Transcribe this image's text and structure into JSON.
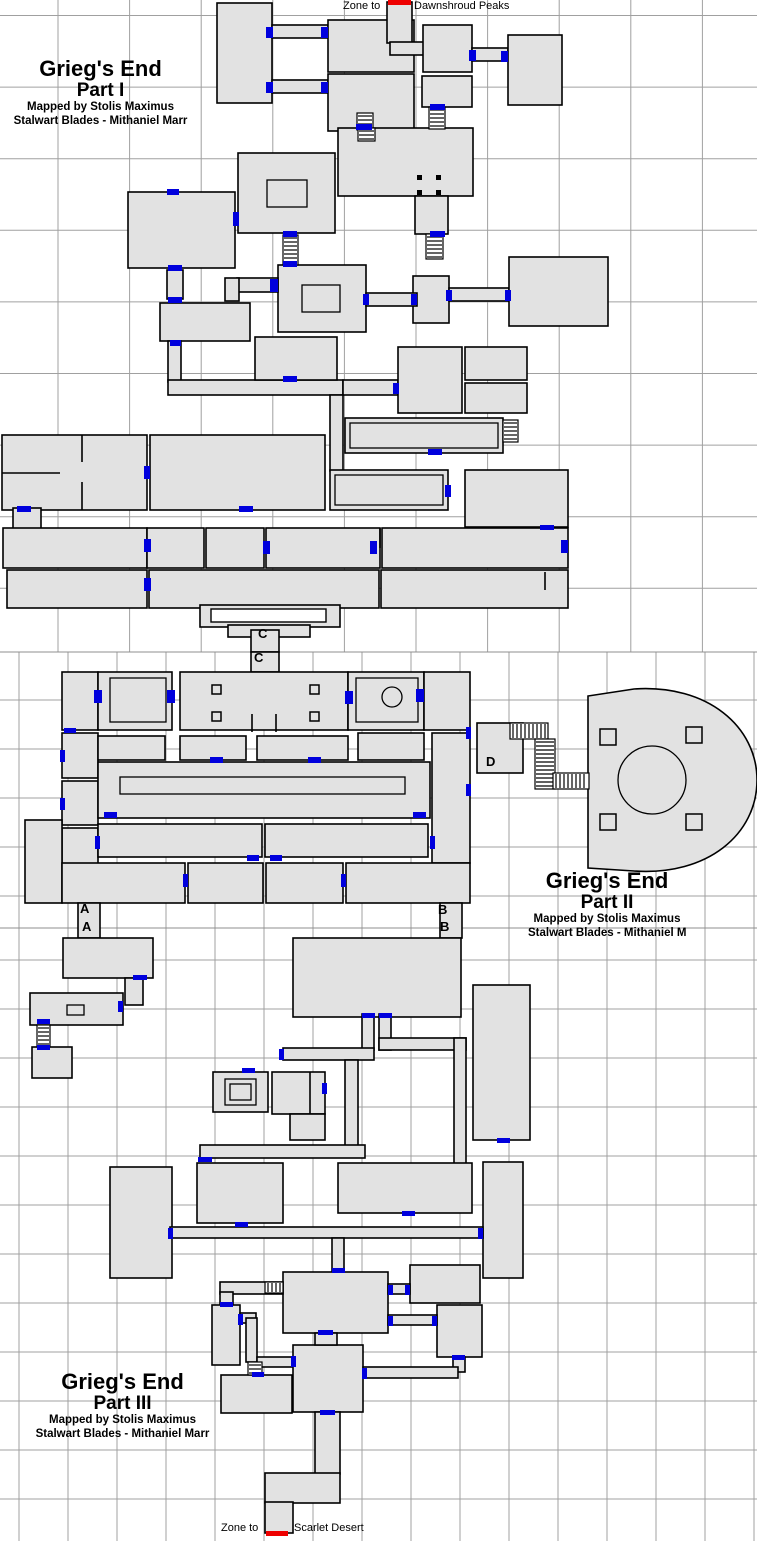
{
  "page": {
    "width": 757,
    "height": 1541,
    "background": "#ffffff"
  },
  "colors": {
    "room_fill": "#e2e2e2",
    "wall": "#000000",
    "door": "#0000dd",
    "zone_line": "#ee0000",
    "grid": "#a0a0a0",
    "seam": "#8f8f8f",
    "ladder_fill": "#ffffff",
    "text": "#000000"
  },
  "zone_labels": {
    "top_prefix": "Zone to",
    "top_zone": "Dawnshroud Peaks",
    "top_prefix_pos": {
      "x": 343,
      "y": 0
    },
    "top_zone_pos": {
      "x": 414,
      "y": 0
    },
    "bottom_prefix": "Zone to",
    "bottom_zone": "Scarlet Desert",
    "bottom_prefix_pos": {
      "x": 221,
      "y": 1522
    },
    "bottom_zone_pos": {
      "x": 294,
      "y": 1522
    }
  },
  "titles": [
    {
      "line1": "Grieg's End",
      "line2": "Part I",
      "line3": "Mapped by Stolis Maximus",
      "line4": "Stalwart Blades - Mithaniel Marr",
      "pos": {
        "x": 8,
        "y": 57,
        "w": 185
      }
    },
    {
      "line1": "Grieg's End",
      "line2": "Part II",
      "line3": "Mapped by Stolis Maximus",
      "line4": "Stalwart Blades - Mithaniel Marr",
      "pos": {
        "x": 528,
        "y": 869,
        "w": 158
      }
    },
    {
      "line1": "Grieg's End",
      "line2": "Part III",
      "line3": "Mapped by Stolis Maximus",
      "line4": "Stalwart Blades - Mithaniel Marr",
      "pos": {
        "x": 25,
        "y": 1370,
        "w": 195
      }
    }
  ],
  "letters": [
    {
      "text": "C",
      "x": 258,
      "y": 626
    },
    {
      "text": "C",
      "y": 650,
      "x": 254
    },
    {
      "text": "A",
      "x": 80,
      "y": 901
    },
    {
      "text": "A",
      "x": 82,
      "y": 919
    },
    {
      "text": "B",
      "x": 438,
      "y": 902
    },
    {
      "text": "B",
      "x": 440,
      "y": 919
    },
    {
      "text": "D",
      "x": 486,
      "y": 754
    }
  ],
  "map": {
    "grid_sections": [
      {
        "y0": 0,
        "y1": 652,
        "vx0": -13.6,
        "vstep": 71.6,
        "hy0": 15.5,
        "hstep": 71.6
      },
      {
        "y0": 652,
        "y1": 928,
        "vx0": 19,
        "vstep": 49,
        "hy0": 651,
        "hstep": 49
      },
      {
        "y0": 928,
        "y1": 1541,
        "vx0": 19,
        "vstep": 49,
        "hy0": 911,
        "hstep": 49
      }
    ],
    "seams": [
      652,
      928
    ],
    "rooms": [
      [
        217,
        3,
        55,
        100
      ],
      [
        272,
        25,
        56,
        13
      ],
      [
        272,
        80,
        56,
        13
      ],
      [
        328,
        20,
        86,
        52
      ],
      [
        328,
        74,
        86,
        57
      ],
      [
        387,
        2,
        25,
        41
      ],
      [
        390,
        42,
        48,
        13
      ],
      [
        423,
        25,
        49,
        47
      ],
      [
        472,
        48,
        36,
        13
      ],
      [
        508,
        35,
        54,
        70
      ],
      [
        422,
        76,
        50,
        31
      ],
      [
        338,
        128,
        135,
        68
      ],
      [
        415,
        196,
        33,
        38
      ],
      [
        413,
        276,
        36,
        47
      ],
      [
        449,
        288,
        60,
        13
      ],
      [
        509,
        257,
        99,
        69
      ],
      [
        238,
        153,
        97,
        80
      ],
      [
        278,
        265,
        88,
        67
      ],
      [
        366,
        293,
        51,
        13
      ],
      [
        128,
        192,
        107,
        76
      ],
      [
        237,
        278,
        41,
        14
      ],
      [
        225,
        278,
        14,
        23
      ],
      [
        167,
        270,
        16,
        29
      ],
      [
        160,
        303,
        90,
        38
      ],
      [
        168,
        341,
        13,
        41
      ],
      [
        168,
        380,
        175,
        15
      ],
      [
        343,
        380,
        55,
        15
      ],
      [
        330,
        395,
        13,
        76
      ],
      [
        398,
        347,
        64,
        66
      ],
      [
        465,
        347,
        62,
        33
      ],
      [
        465,
        383,
        62,
        30
      ],
      [
        345,
        418,
        158,
        35
      ],
      [
        330,
        470,
        118,
        40
      ],
      [
        465,
        470,
        103,
        57
      ],
      [
        2,
        435,
        145,
        75
      ],
      [
        150,
        435,
        175,
        75
      ],
      [
        13,
        508,
        28,
        22
      ],
      [
        3,
        528,
        144,
        40
      ],
      [
        147,
        528,
        57,
        40
      ],
      [
        206,
        528,
        58,
        40
      ],
      [
        266,
        528,
        114,
        40
      ],
      [
        382,
        528,
        186,
        40
      ],
      [
        7,
        570,
        140,
        38
      ],
      [
        149,
        570,
        230,
        38
      ],
      [
        381,
        570,
        187,
        38
      ],
      [
        200,
        605,
        140,
        22
      ],
      [
        228,
        625,
        82,
        12
      ],
      [
        251,
        630,
        28,
        22
      ],
      [
        255,
        337,
        82,
        43
      ],
      [
        251,
        652,
        28,
        20
      ],
      [
        62,
        672,
        36,
        58
      ],
      [
        98,
        672,
        74,
        58
      ],
      [
        180,
        672,
        168,
        58
      ],
      [
        348,
        672,
        76,
        58
      ],
      [
        424,
        672,
        46,
        58
      ],
      [
        62,
        733,
        36,
        45
      ],
      [
        62,
        781,
        36,
        44
      ],
      [
        98,
        736,
        67,
        24
      ],
      [
        180,
        736,
        66,
        24
      ],
      [
        257,
        736,
        91,
        24
      ],
      [
        358,
        733,
        66,
        27
      ],
      [
        98,
        762,
        332,
        56
      ],
      [
        62,
        828,
        36,
        38
      ],
      [
        25,
        820,
        37,
        83
      ],
      [
        432,
        733,
        38,
        130
      ],
      [
        98,
        824,
        164,
        33
      ],
      [
        265,
        824,
        163,
        33
      ],
      [
        62,
        863,
        123,
        40
      ],
      [
        188,
        863,
        75,
        40
      ],
      [
        266,
        863,
        77,
        40
      ],
      [
        346,
        863,
        124,
        40
      ],
      [
        78,
        903,
        22,
        35
      ],
      [
        440,
        903,
        22,
        35
      ],
      [
        477,
        723,
        46,
        50
      ],
      [
        63,
        938,
        90,
        40
      ],
      [
        125,
        978,
        18,
        27
      ],
      [
        30,
        993,
        93,
        32
      ],
      [
        32,
        1047,
        40,
        31
      ],
      [
        293,
        938,
        168,
        79
      ],
      [
        473,
        985,
        57,
        155
      ],
      [
        362,
        1014,
        12,
        36
      ],
      [
        283,
        1048,
        91,
        12
      ],
      [
        379,
        1014,
        12,
        36
      ],
      [
        379,
        1038,
        87,
        12
      ],
      [
        454,
        1038,
        12,
        126
      ],
      [
        213,
        1072,
        55,
        40
      ],
      [
        272,
        1072,
        53,
        42
      ],
      [
        290,
        1114,
        35,
        26
      ],
      [
        345,
        1060,
        13,
        88
      ],
      [
        200,
        1145,
        165,
        13
      ],
      [
        110,
        1167,
        62,
        111
      ],
      [
        197,
        1163,
        86,
        60
      ],
      [
        338,
        1163,
        134,
        50
      ],
      [
        483,
        1162,
        40,
        116
      ],
      [
        170,
        1227,
        313,
        11
      ],
      [
        332,
        1238,
        12,
        36
      ],
      [
        283,
        1272,
        105,
        61
      ],
      [
        220,
        1282,
        63,
        12
      ],
      [
        220,
        1292,
        13,
        17
      ],
      [
        212,
        1305,
        28,
        60
      ],
      [
        410,
        1265,
        70,
        38
      ],
      [
        388,
        1284,
        22,
        10
      ],
      [
        437,
        1305,
        45,
        52
      ],
      [
        388,
        1315,
        49,
        10
      ],
      [
        240,
        1313,
        16,
        10
      ],
      [
        246,
        1318,
        11,
        44
      ],
      [
        257,
        1357,
        36,
        10
      ],
      [
        221,
        1375,
        71,
        38
      ],
      [
        293,
        1345,
        70,
        67
      ],
      [
        453,
        1357,
        12,
        15
      ],
      [
        363,
        1367,
        95,
        11
      ],
      [
        315,
        1333,
        22,
        12
      ],
      [
        315,
        1412,
        25,
        62
      ],
      [
        265,
        1473,
        75,
        30
      ],
      [
        265,
        1502,
        28,
        31
      ]
    ],
    "dome_path": "M588,868 L588,696 L634,689 C708,684 757,727 757,780 C757,834 708,876 634,871 Z",
    "white_rects": [
      [
        211,
        609,
        115,
        13
      ]
    ],
    "inner_rects": [
      [
        267,
        180,
        40,
        27
      ],
      [
        302,
        285,
        38,
        27
      ],
      [
        350,
        423,
        148,
        25
      ],
      [
        335,
        475,
        108,
        30
      ],
      [
        110,
        678,
        56,
        44
      ],
      [
        356,
        678,
        62,
        44
      ],
      [
        120,
        777,
        285,
        17
      ],
      [
        67,
        1005,
        17,
        10
      ],
      [
        225,
        1079,
        31,
        26
      ],
      [
        230,
        1084,
        21,
        16
      ]
    ],
    "partitions": [
      [
        2,
        473,
        60,
        473
      ],
      [
        82,
        435,
        82,
        462
      ],
      [
        82,
        482,
        82,
        510
      ],
      [
        252,
        714,
        252,
        732
      ],
      [
        276,
        714,
        276,
        732
      ],
      [
        380,
        528,
        380,
        548
      ],
      [
        545,
        572,
        545,
        590
      ],
      [
        310,
        1072,
        310,
        1114
      ]
    ],
    "ladders": [
      [
        357,
        113,
        16,
        17,
        "v"
      ],
      [
        429,
        107,
        16,
        22,
        "v"
      ],
      [
        358,
        128,
        17,
        13,
        "v"
      ],
      [
        426,
        234,
        17,
        25,
        "v"
      ],
      [
        283,
        235,
        15,
        30,
        "v"
      ],
      [
        503,
        420,
        15,
        22,
        "v"
      ],
      [
        510,
        723,
        38,
        16,
        "h"
      ],
      [
        535,
        739,
        20,
        50,
        "v"
      ],
      [
        553,
        773,
        36,
        16,
        "h"
      ],
      [
        37,
        1025,
        13,
        22,
        "v"
      ],
      [
        265,
        1282,
        18,
        11,
        "h"
      ],
      [
        248,
        1362,
        14,
        13,
        "v"
      ]
    ],
    "doors": [
      [
        266,
        27,
        7,
        11
      ],
      [
        321,
        27,
        7,
        11
      ],
      [
        266,
        82,
        7,
        11
      ],
      [
        321,
        82,
        7,
        11
      ],
      [
        469,
        50,
        7,
        11
      ],
      [
        501,
        51,
        7,
        11
      ],
      [
        356,
        124,
        16,
        6
      ],
      [
        430,
        104,
        15,
        6
      ],
      [
        430,
        231,
        15,
        6
      ],
      [
        233,
        212,
        6,
        14
      ],
      [
        167,
        189,
        12,
        6
      ],
      [
        283,
        231,
        14,
        6
      ],
      [
        283,
        261,
        14,
        6
      ],
      [
        363,
        294,
        6,
        11
      ],
      [
        411,
        294,
        6,
        11
      ],
      [
        446,
        290,
        6,
        11
      ],
      [
        505,
        290,
        6,
        11
      ],
      [
        168,
        265,
        14,
        6
      ],
      [
        168,
        297,
        14,
        6
      ],
      [
        170,
        340,
        11,
        6
      ],
      [
        283,
        376,
        14,
        6
      ],
      [
        270,
        279,
        8,
        13
      ],
      [
        393,
        383,
        6,
        11
      ],
      [
        428,
        449,
        14,
        6
      ],
      [
        445,
        485,
        6,
        12
      ],
      [
        540,
        525,
        14,
        5
      ],
      [
        17,
        506,
        14,
        6
      ],
      [
        144,
        466,
        6,
        13
      ],
      [
        239,
        506,
        14,
        6
      ],
      [
        144,
        539,
        7,
        13
      ],
      [
        263,
        541,
        7,
        13
      ],
      [
        370,
        541,
        7,
        13
      ],
      [
        144,
        578,
        7,
        13
      ],
      [
        561,
        540,
        7,
        13
      ],
      [
        94,
        690,
        8,
        13
      ],
      [
        167,
        690,
        8,
        13
      ],
      [
        345,
        691,
        8,
        13
      ],
      [
        416,
        689,
        8,
        13
      ],
      [
        64,
        728,
        12,
        5
      ],
      [
        60,
        750,
        5,
        12
      ],
      [
        60,
        798,
        5,
        12
      ],
      [
        210,
        757,
        13,
        6
      ],
      [
        308,
        757,
        13,
        6
      ],
      [
        104,
        812,
        13,
        6
      ],
      [
        413,
        812,
        13,
        6
      ],
      [
        95,
        836,
        5,
        13
      ],
      [
        430,
        836,
        5,
        13
      ],
      [
        247,
        855,
        12,
        6
      ],
      [
        270,
        855,
        12,
        6
      ],
      [
        183,
        874,
        5,
        13
      ],
      [
        341,
        874,
        5,
        13
      ],
      [
        466,
        727,
        5,
        12
      ],
      [
        466,
        784,
        5,
        12
      ],
      [
        133,
        975,
        14,
        5
      ],
      [
        118,
        1001,
        5,
        11
      ],
      [
        37,
        1019,
        13,
        5
      ],
      [
        37,
        1045,
        13,
        5
      ],
      [
        362,
        1013,
        13,
        5
      ],
      [
        379,
        1013,
        13,
        5
      ],
      [
        279,
        1049,
        5,
        11
      ],
      [
        242,
        1068,
        13,
        5
      ],
      [
        322,
        1083,
        5,
        11
      ],
      [
        497,
        1138,
        13,
        5
      ],
      [
        235,
        1222,
        13,
        5
      ],
      [
        402,
        1211,
        13,
        5
      ],
      [
        168,
        1228,
        5,
        11
      ],
      [
        478,
        1228,
        5,
        11
      ],
      [
        332,
        1268,
        13,
        5
      ],
      [
        198,
        1157,
        14,
        5
      ],
      [
        220,
        1302,
        13,
        5
      ],
      [
        238,
        1314,
        5,
        11
      ],
      [
        388,
        1285,
        5,
        10
      ],
      [
        405,
        1285,
        5,
        10
      ],
      [
        388,
        1316,
        5,
        10
      ],
      [
        432,
        1316,
        5,
        10
      ],
      [
        452,
        1355,
        13,
        5
      ],
      [
        362,
        1368,
        5,
        11
      ],
      [
        291,
        1356,
        5,
        11
      ],
      [
        318,
        1330,
        15,
        5
      ],
      [
        320,
        1410,
        15,
        5
      ],
      [
        252,
        1372,
        12,
        5
      ]
    ],
    "zone_lines": [
      [
        388,
        0,
        23,
        5
      ],
      [
        266,
        1531,
        22,
        5
      ]
    ],
    "pillars": [
      [
        212,
        685,
        9,
        9
      ],
      [
        310,
        685,
        9,
        9
      ],
      [
        212,
        712,
        9,
        9
      ],
      [
        310,
        712,
        9,
        9
      ],
      [
        600,
        729,
        16,
        16
      ],
      [
        686,
        727,
        16,
        16
      ],
      [
        600,
        814,
        16,
        16
      ],
      [
        686,
        814,
        16,
        16
      ]
    ],
    "dots": [
      [
        417,
        175,
        5,
        5
      ],
      [
        436,
        175,
        5,
        5
      ],
      [
        417,
        190,
        5,
        5
      ],
      [
        436,
        190,
        5,
        5
      ]
    ],
    "circles": [
      [
        392,
        697,
        10
      ],
      [
        652,
        780,
        34
      ]
    ]
  }
}
